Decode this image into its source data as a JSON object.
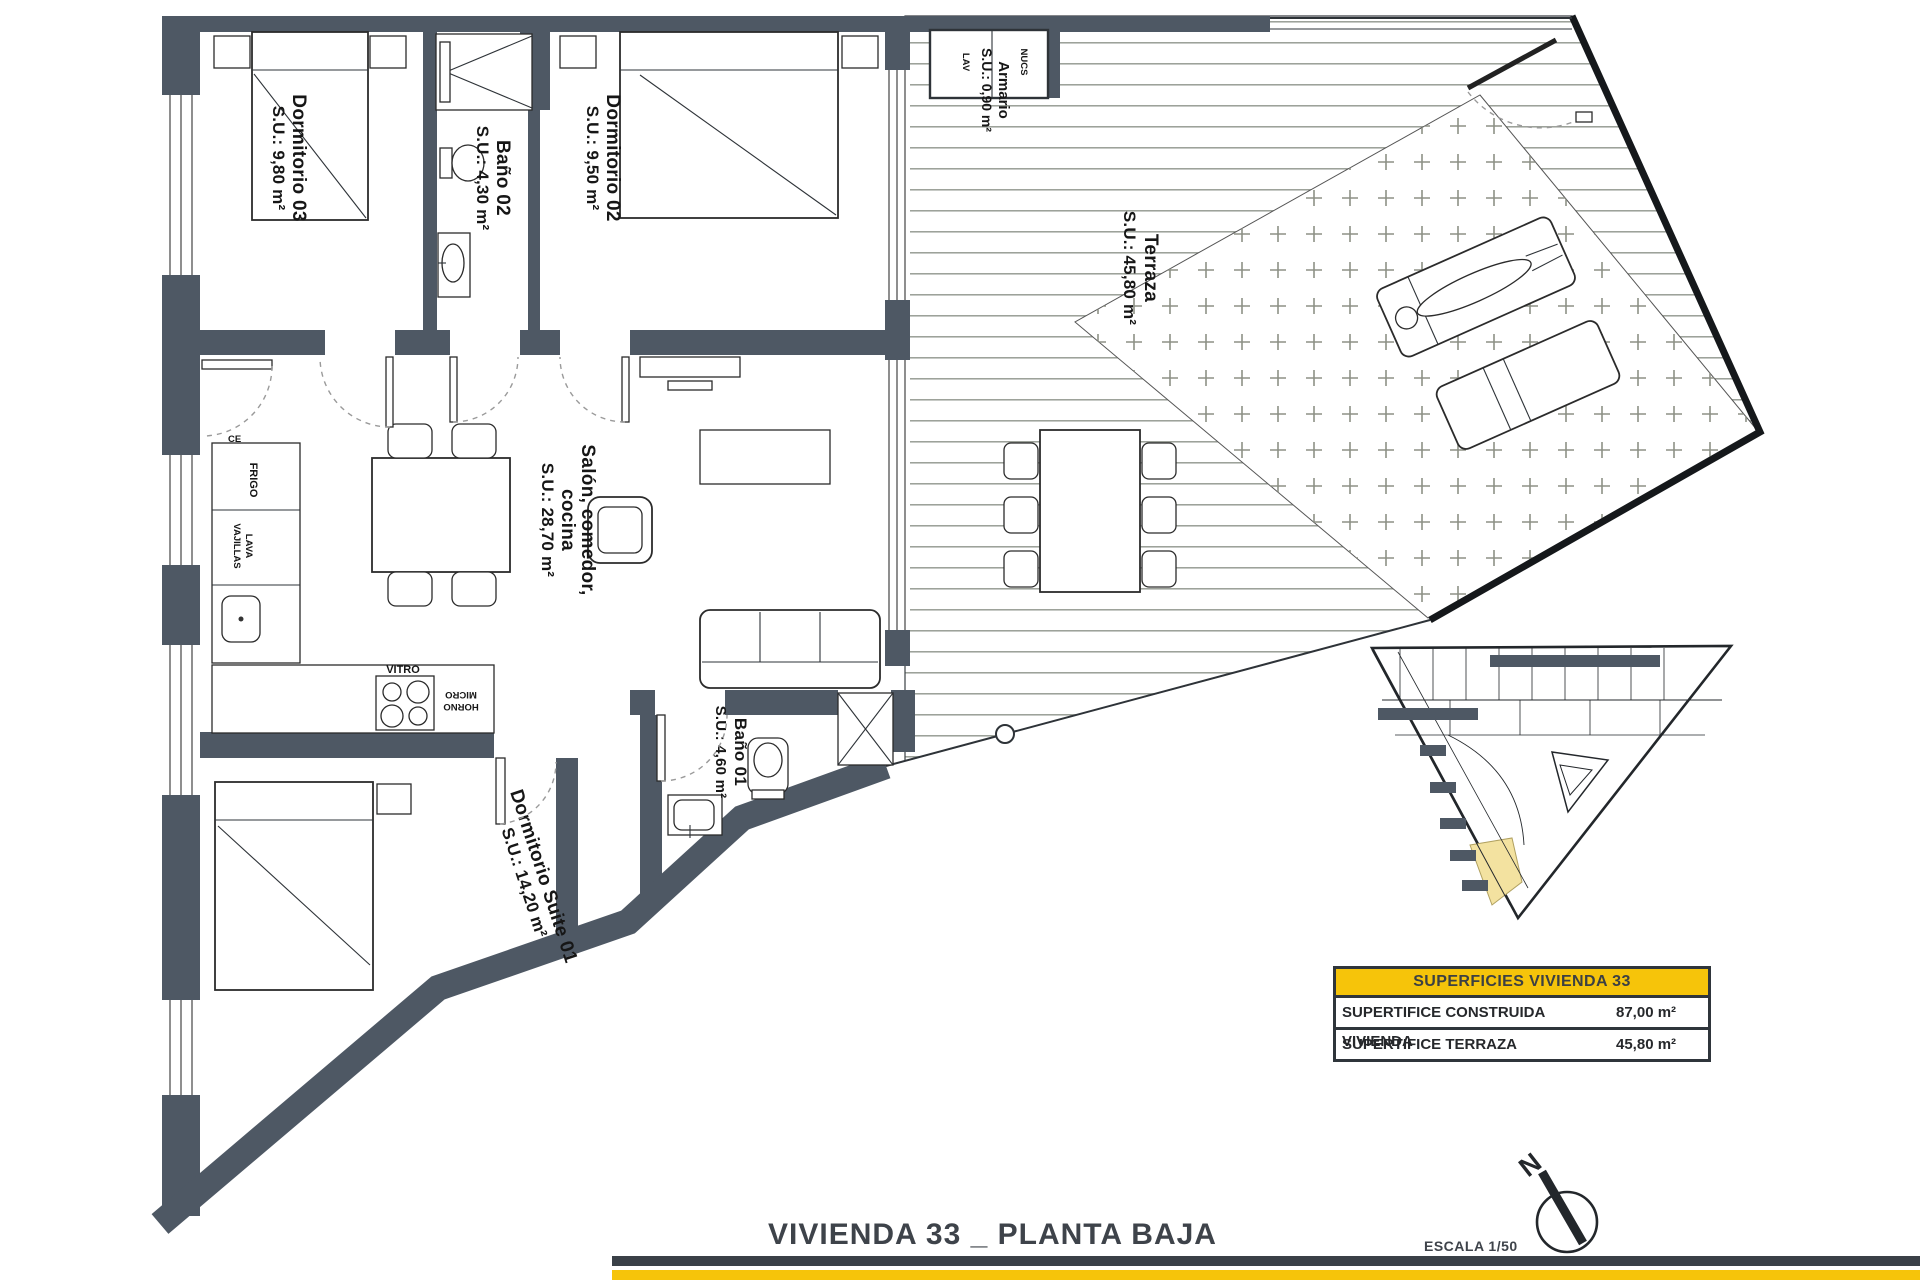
{
  "plan": {
    "rooms": {
      "dormitorio03": {
        "name": "Dormitorio 03",
        "area": "S.U.: 9,80 m²"
      },
      "bano02": {
        "name": "Baño 02",
        "area": "S.U.: 4,30 m²"
      },
      "dormitorio02": {
        "name": "Dormitorio 02",
        "area": "S.U.: 9,50 m²"
      },
      "armario": {
        "name": "Armario",
        "area": "S.U.: 0,90 m²"
      },
      "terraza": {
        "name": "Terraza",
        "area": "S.U.: 45,80 m²"
      },
      "salon": {
        "name_line1": "Salón, comedor,",
        "name_line2": "cocina",
        "area": "S.U.: 28,70 m²"
      },
      "bano01": {
        "name": "Baño 01",
        "area": "S.U.: 4,60 m²"
      },
      "suite01": {
        "name": "Dormitorio Suite 01",
        "area": "S.U.: 14,20 m²"
      }
    },
    "appliances": {
      "frigo": "FRIGO",
      "lava": "LAVA",
      "vajillas": "VAJILLAS",
      "vitro": "VITRO",
      "horno": "HORNO",
      "micro": "MICRO",
      "lav": "LAV",
      "nucs": "NUCS",
      "ce": "CE"
    }
  },
  "summary_table": {
    "header": "SUPERFICIES VIVIENDA 33",
    "rows": [
      {
        "label": "SUPERTIFICE CONSTRUIDA VIVIENDA",
        "value": "87,00 m²"
      },
      {
        "label": "SUPERTIFICE TERRAZA",
        "value": "45,80 m²"
      }
    ]
  },
  "footer": {
    "title": "VIVIENDA 33 _ PLANTA BAJA",
    "scale": "ESCALA 1/50",
    "north_letter": "N"
  },
  "colors": {
    "wall": "#4E5864",
    "accent_yellow": "#F6C40A",
    "site_highlight": "#F3E2A0",
    "fence": "#15181b"
  }
}
